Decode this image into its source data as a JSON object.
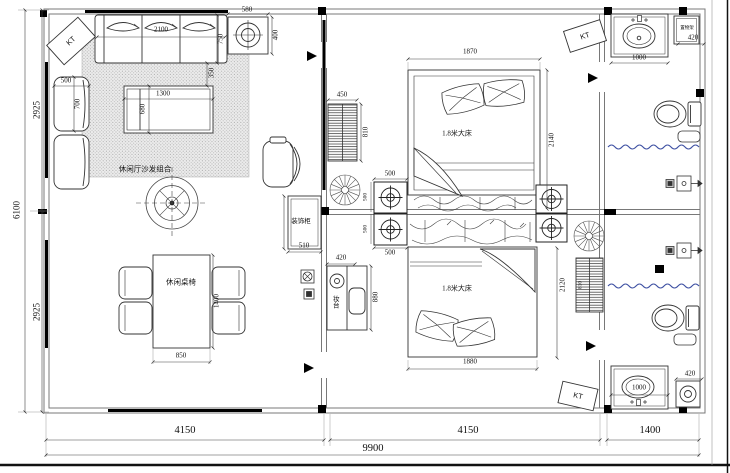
{
  "colors": {
    "curtain_blue": "#3f51a3",
    "linework": "#333333",
    "paper": "#ffffff"
  },
  "overall": {
    "width_total": "9900",
    "width_living": "4150",
    "width_bedrooms": "4150",
    "width_bath": "1400",
    "height_total": "6100",
    "height_upper": "2925",
    "height_lower": "2925"
  },
  "living": {
    "sofa_area_label": "休闲厅沙发组合",
    "dining_label": "休闲桌椅",
    "sofa_w": "2100",
    "sofa_d": "750",
    "sofa_gap": "350",
    "hood_w": "580",
    "hood_d": "400",
    "side_chair_w": "500",
    "side_chair_d": "700",
    "coffee_w": "1300",
    "coffee_d": "680",
    "dining_w": "850",
    "dining_l": "1400",
    "cabinet_label": "装饰柜",
    "cabinet_w": "510"
  },
  "bedroom1": {
    "bed_label": "1.8米大床",
    "bed_w": "1870",
    "bed_l": "2140",
    "wardrobe_w": "450",
    "wardrobe_d": "810",
    "vent_top_w": "500",
    "vent_bottom_w": "500",
    "vent_top_d": "500",
    "vent_bottom_d": "500"
  },
  "bedroom2": {
    "bed_label": "1.8米大床",
    "bed_w": "1880",
    "bed_l": "2120",
    "dresser_label": "妆台",
    "dresser_w": "420",
    "dresser_l": "880",
    "radiator_d": "810"
  },
  "bath_top": {
    "sink_w": "1000",
    "shelf_label": "置物架",
    "shelf_w": "420"
  },
  "bath_bottom": {
    "sink_w": "1000",
    "washer_w": "420"
  },
  "ac": {
    "kt1": "KT",
    "kt2": "KT",
    "kt3": "KT"
  }
}
